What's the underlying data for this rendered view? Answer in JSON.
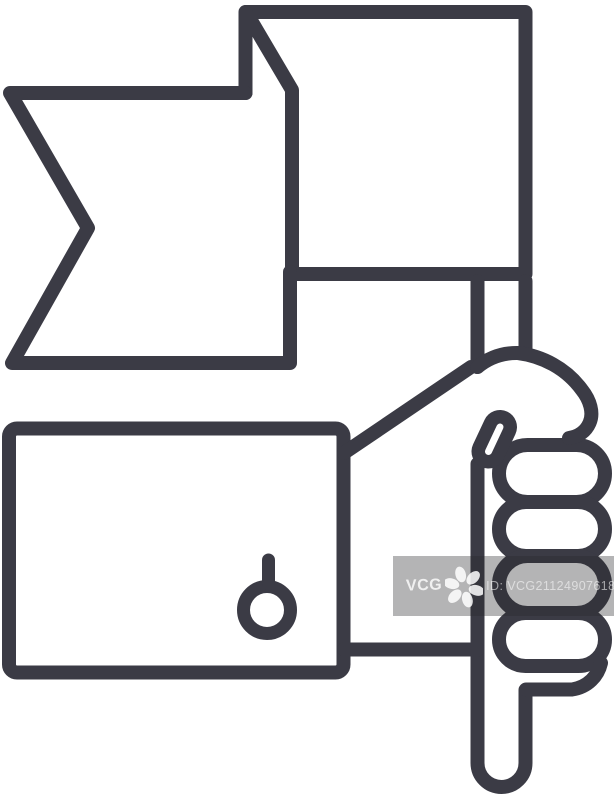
{
  "canvas": {
    "width": 614,
    "height": 800,
    "background_color": "#ffffff"
  },
  "icon": {
    "name": "hand-holding-flag-line-icon",
    "stroke_color": "#3b3b45",
    "stroke_width": 14,
    "parts": [
      "swallowtail-flag",
      "pennant-flag",
      "flag-pole",
      "hand-fist",
      "thumb",
      "fingers",
      "sleeve-cuff",
      "cuff-button"
    ]
  },
  "watermark": {
    "brand": "VCG",
    "id_text": "ID: VCG211249076181",
    "band_color": "rgba(40,40,42,0.35)",
    "logo_color": "#ffffff",
    "flower_icon": "vcg-flower-icon"
  }
}
